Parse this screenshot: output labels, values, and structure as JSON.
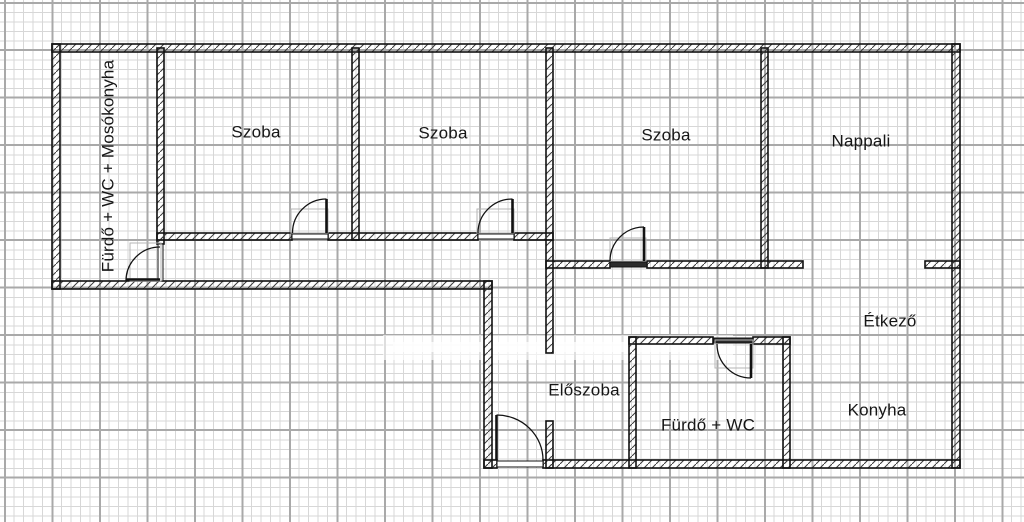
{
  "plan": {
    "rooms": [
      {
        "id": "bath-wc-laundry",
        "label": "Fürdő + WC + Mosókonyha"
      },
      {
        "id": "room-1",
        "label": "Szoba"
      },
      {
        "id": "room-2",
        "label": "Szoba"
      },
      {
        "id": "room-3",
        "label": "Szoba"
      },
      {
        "id": "living-room",
        "label": "Nappali"
      },
      {
        "id": "hallway",
        "label": "Előszoba"
      },
      {
        "id": "bath-wc",
        "label": "Fürdő + WC"
      },
      {
        "id": "dining",
        "label": "Étkező"
      },
      {
        "id": "kitchen",
        "label": "Konyha"
      }
    ],
    "colors": {
      "wall_line": "#121212",
      "wall_fill": "#ffffff",
      "grid_minor": "#d7d7d7",
      "grid_major": "#a9a9a9",
      "door_frame": "#b5b5b5",
      "paper": "#ffffff"
    }
  }
}
